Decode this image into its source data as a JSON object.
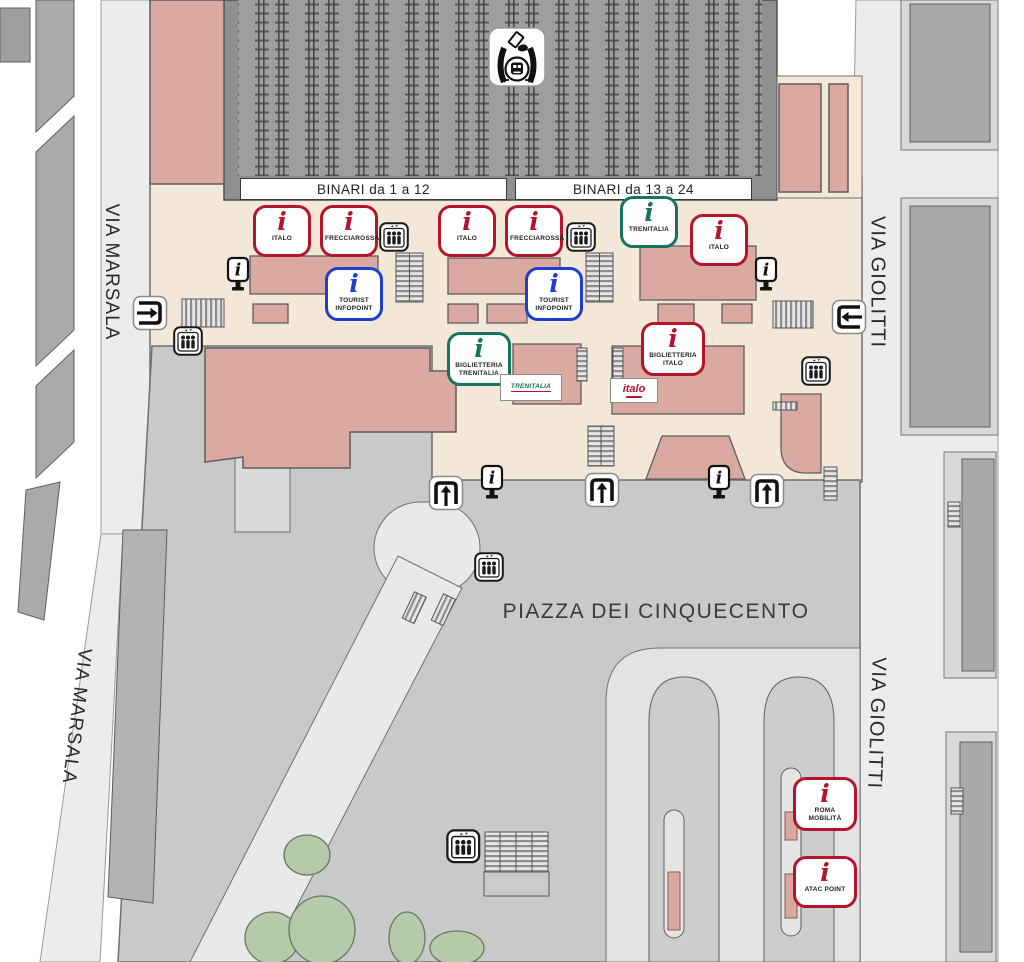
{
  "binari": {
    "left": "BINARI da 1 a 12",
    "right": "BINARI da 13 a 24"
  },
  "streets": {
    "via_marsala": "VIA MARSALA",
    "via_giolitti": "VIA GIOLITTI"
  },
  "piazza_label": "PIAZZA DEI CINQUECENTO",
  "icons": {
    "info_glyph": "i"
  },
  "logos": {
    "trenitalia": "TRENITALIA",
    "italo": "italo"
  },
  "colors": {
    "red": "#b5152b",
    "green": "#16735e",
    "blue": "#1d3ed1",
    "pink": "#d9a9a2",
    "cream": "#f3e7d8",
    "piazza_gray": "#c9c9c9",
    "track_gray": "#9e9e9e"
  },
  "info_points": [
    {
      "label": "ITALO",
      "color": "red"
    },
    {
      "label": "FRECCIAROSSA",
      "color": "red"
    },
    {
      "label": "ITALO",
      "color": "red"
    },
    {
      "label": "FRECCIAROSSA",
      "color": "red"
    },
    {
      "label": "TRENITALIA",
      "color": "green"
    },
    {
      "label": "ITALO",
      "color": "red"
    },
    {
      "label": "TOURIST INFOPOINT",
      "color": "blue"
    },
    {
      "label": "TOURIST INFOPOINT",
      "color": "blue"
    },
    {
      "label": "BIGLIETTERIA TRENITALIA",
      "color": "green"
    },
    {
      "label": "BIGLIETTERIA ITALO",
      "color": "red"
    },
    {
      "label": "ROMA MOBILITÀ",
      "color": "red"
    },
    {
      "label": "ATAC POINT",
      "color": "red"
    }
  ]
}
